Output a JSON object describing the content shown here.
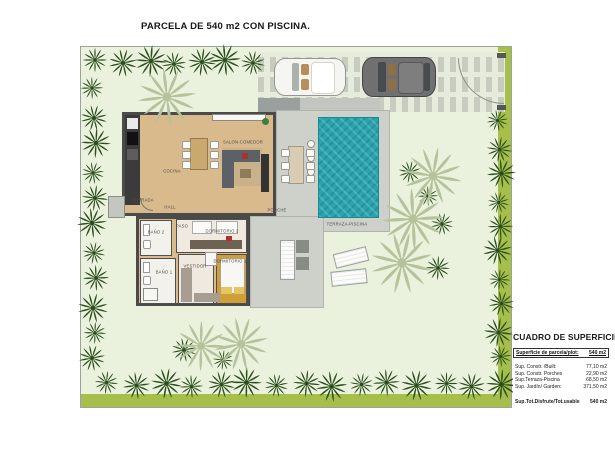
{
  "title": "PARCELA DE 540 m2 CON PISCINA.",
  "plan": {
    "rooms": [
      {
        "id": "cocina",
        "label": "COCINA"
      },
      {
        "id": "salon-comedor",
        "label": "SALON-COMEDOR"
      },
      {
        "id": "entrada",
        "label": "ENTRADA"
      },
      {
        "id": "hall",
        "label": "HALL"
      },
      {
        "id": "paso",
        "label": "PASO"
      },
      {
        "id": "bano2",
        "label": "BAÑO 2"
      },
      {
        "id": "dormitorio2",
        "label": "DORMITORIO 2"
      },
      {
        "id": "bano1",
        "label": "BAÑO 1"
      },
      {
        "id": "vestidor",
        "label": "VESTIDOR"
      },
      {
        "id": "dormitorio1",
        "label": "DORMITORIO 1"
      },
      {
        "id": "porche",
        "label": "PORCHE"
      },
      {
        "id": "terraza-piscina",
        "label": "TERRAZA-PISCINA"
      }
    ]
  },
  "surface_table": {
    "title": "CUADRO DE SUPERFICIE",
    "header": {
      "label": "Superficie de parcela/plot:",
      "value": "540 m2"
    },
    "rows": [
      {
        "label": "Sup. Constr. /Built:",
        "value": "77,10 m2"
      },
      {
        "label": "Sup. Constr. Porches",
        "value": "22,90 m2"
      },
      {
        "label": "Sup.Terraza-Piscina",
        "value": "68,50 m2"
      },
      {
        "label": "Sup. Jardín/ Garden:",
        "value": "371,50 m2"
      }
    ],
    "total": {
      "label": "Sup.Tot.Disfrute/Tot.usable",
      "value": "540 m2"
    }
  },
  "colors": {
    "lawn": "#eaf2dd",
    "hedge": "#2c4e1e",
    "lawn_strip": "#a6bf4b",
    "palm": "#b5c29b",
    "terrace": "#cdd1ca",
    "pool_water": "#2ba4ae",
    "wood_floor": "#d9ba8d",
    "bedroom1_floor": "#d09e36",
    "wall": "#4a4a4a"
  }
}
